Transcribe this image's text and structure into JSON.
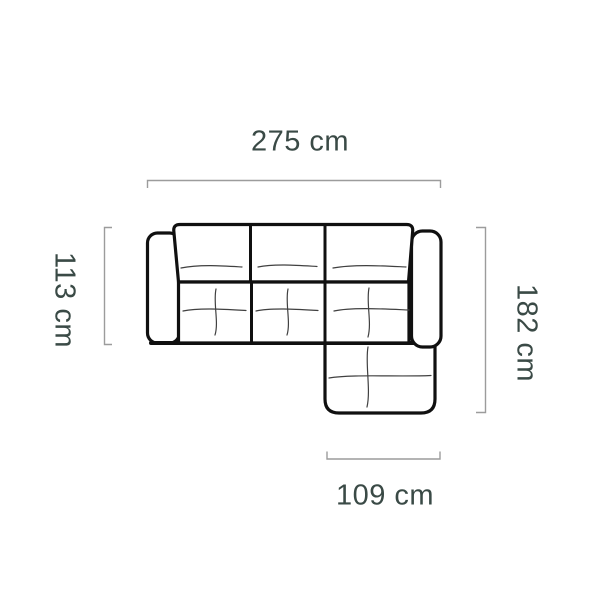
{
  "diagram": {
    "dimension_labels": {
      "top_width": "275 cm",
      "left_depth": "113 cm",
      "right_length": "182 cm",
      "bottom_chaise_width": "109 cm"
    }
  },
  "colors": {
    "outline": "#101010",
    "crease": "#404040",
    "bracket": "#9c9c9c",
    "label_text": "#3a4a46",
    "background": "#ffffff"
  }
}
